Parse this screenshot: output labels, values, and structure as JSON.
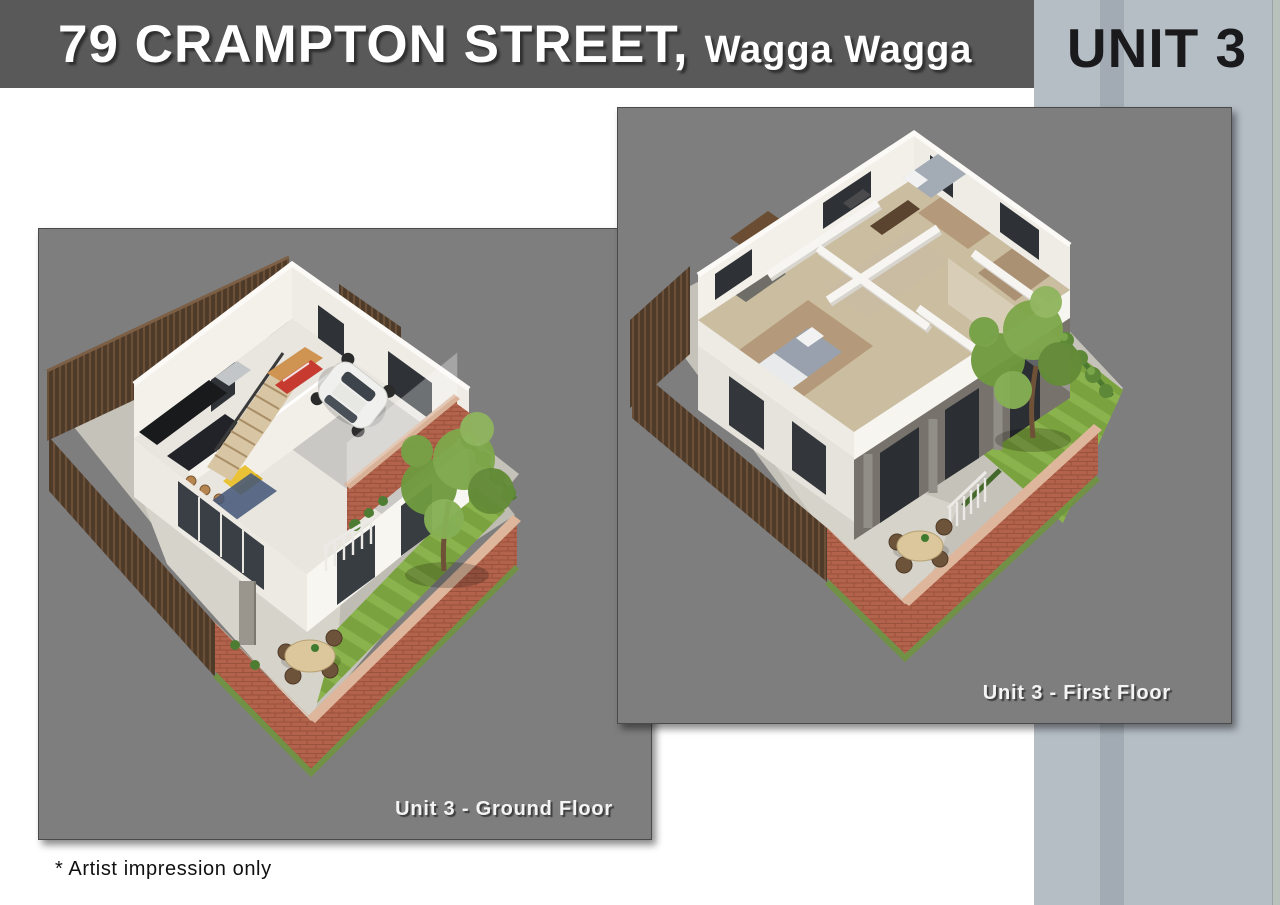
{
  "header": {
    "address_primary": "79 CRAMPTON STREET,",
    "address_secondary": "Wagga Wagga",
    "unit_label": "UNIT 3"
  },
  "panels": {
    "ground": {
      "caption": "Unit 3 - Ground Floor"
    },
    "first": {
      "caption": "Unit 3 - First Floor"
    }
  },
  "footnote": "* Artist impression only",
  "colors": {
    "header_bg": "#595959",
    "title_text": "#ffffff",
    "unit_strip_bg": "#b5bdc5",
    "unit_strip_band": "#a2aab3",
    "unit_text": "#1a1a1c",
    "panel_bg": "#7e7e7e",
    "panel_border": "#4a4a4a",
    "caption_text": "#f4f4f4",
    "footnote_text": "#101010",
    "brick": "#b3624b",
    "lawn": "#7aa23e",
    "timber": "#4e3a29",
    "wall_white": "#f4f1eb",
    "glass_dark": "#33373c"
  }
}
